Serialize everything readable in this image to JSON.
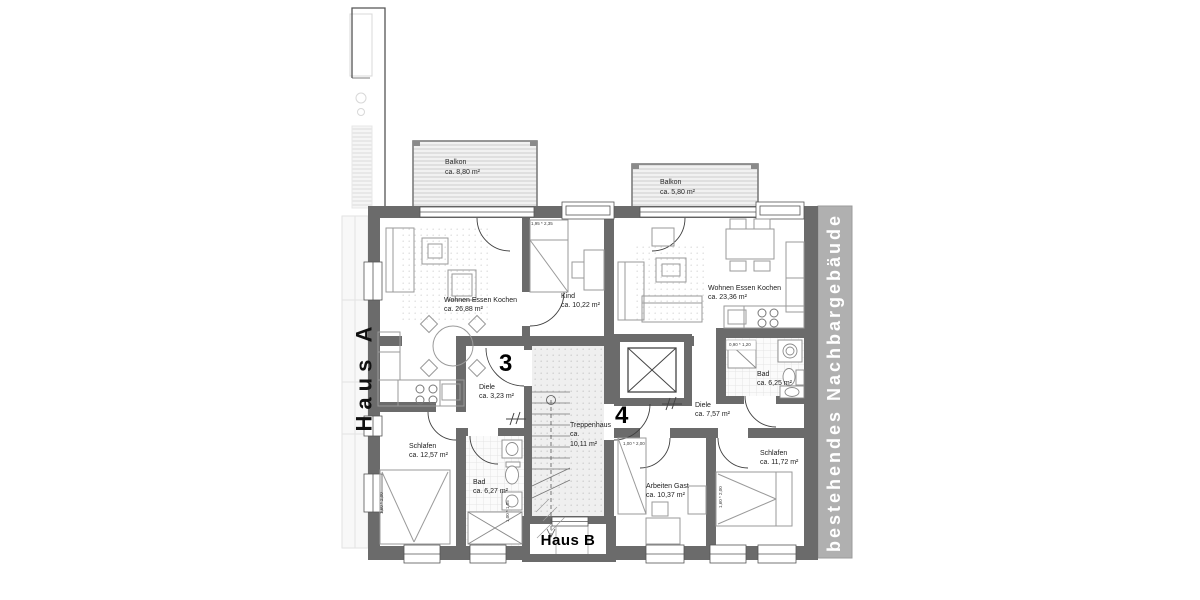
{
  "plan": {
    "house_a_label": "Haus A",
    "house_b_label": "Haus B",
    "neighbor_label": "bestehendes Nachbargebäude",
    "apt_left_number": "3",
    "apt_right_number": "4"
  },
  "balconies": [
    {
      "name": "Balkon",
      "area": "ca. 8,80 m²"
    },
    {
      "name": "Balkon",
      "area": "ca. 5,80 m²"
    }
  ],
  "rooms": [
    {
      "name": "Wohnen Essen Kochen",
      "area": "ca. 26,88 m²"
    },
    {
      "name": "Kind",
      "area": "ca. 10,22 m²"
    },
    {
      "name": "Diele",
      "area": "ca. 3,23 m²"
    },
    {
      "name": "Schlafen",
      "area": "ca. 12,57 m²"
    },
    {
      "name": "Bad",
      "area": "ca. 6,27 m²"
    },
    {
      "name": "Treppenhaus",
      "area_prefix": "ca.",
      "area": "10,11 m²"
    },
    {
      "name": "Wohnen Essen Kochen",
      "area": "ca. 23,36 m²"
    },
    {
      "name": "Bad",
      "area": "ca. 6,25 m²"
    },
    {
      "name": "Diele",
      "area": "ca. 7,57 m²"
    },
    {
      "name": "Arbeiten Gast",
      "area": "ca. 10,37 m²"
    },
    {
      "name": "Schlafen",
      "area": "ca. 11,72 m²"
    }
  ],
  "dimensions": {
    "kind_window": "1,95 * 2,35",
    "bad4_window": "0,90 * 1,20",
    "arbeiten_door": "1,00 * 2,00",
    "bed3": "1,60 * 2,00",
    "bed4": "1,60 * 2,00",
    "bad3_shower": "1,00 * 1,85"
  },
  "colors": {
    "wall": "#6b6b6b",
    "neighbor_band": "#b0b0b0",
    "stair_floor": "#efefef",
    "balcony_stripe": "#cdcdcd"
  }
}
